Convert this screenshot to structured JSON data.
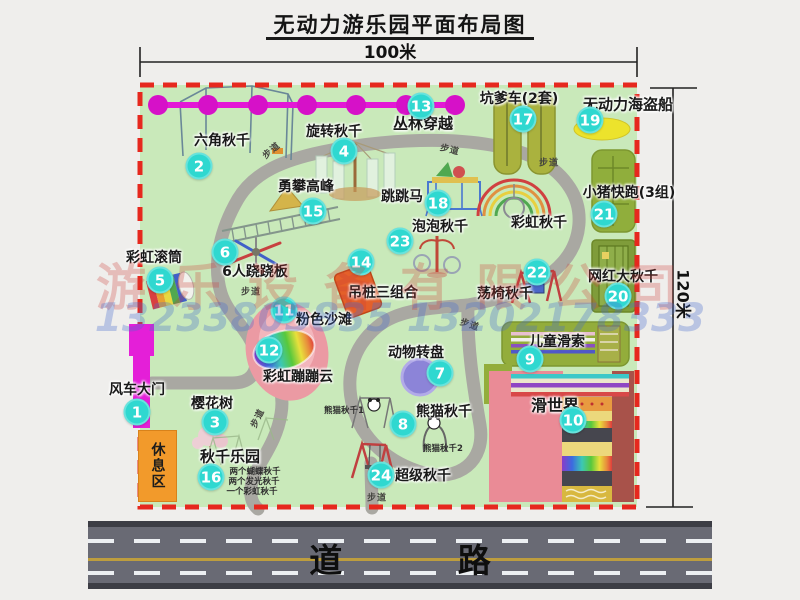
{
  "title": "无动力游乐园平面布局图",
  "dimensions": {
    "width": "100米",
    "height": "120米"
  },
  "road": {
    "label": "道 路"
  },
  "watermark": {
    "company": "游乐设备有限公司",
    "phone": "13233805835 13202178333"
  },
  "rest_area": {
    "label": "休息区"
  },
  "colors": {
    "badge": "#2fd8d0",
    "border": "#e6281e",
    "gate": "#e41fd8",
    "chain": "#e318d6",
    "map_bg": "#c9e9ba"
  },
  "attractions": [
    {
      "num": "1",
      "label": "风车大门",
      "lx": 137,
      "ly": 389,
      "bx": 137,
      "by": 412
    },
    {
      "num": "2",
      "label": "六角秋千",
      "lx": 222,
      "ly": 140,
      "bx": 199,
      "by": 166
    },
    {
      "num": "3",
      "label": "樱花树",
      "lx": 212,
      "ly": 403,
      "bx": 215,
      "by": 422
    },
    {
      "num": "4",
      "label": "旋转秋千",
      "lx": 334,
      "ly": 131,
      "bx": 344,
      "by": 151
    },
    {
      "num": "5",
      "label": "彩虹滚筒",
      "lx": 154,
      "ly": 257,
      "bx": 160,
      "by": 280
    },
    {
      "num": "6",
      "label": "6人跷跷板",
      "lx": 255,
      "ly": 271,
      "bx": 225,
      "by": 252
    },
    {
      "num": "7",
      "label": "动物转盘",
      "lx": 416,
      "ly": 352,
      "bx": 440,
      "by": 373
    },
    {
      "num": "8",
      "label": "熊猫秋千",
      "lx": 444,
      "ly": 411,
      "bx": 403,
      "by": 424,
      "subs": [
        {
          "t": "熊猫秋千1",
          "x": 344,
          "y": 410
        },
        {
          "t": "熊猫秋千2",
          "x": 443,
          "y": 448
        }
      ]
    },
    {
      "num": "9",
      "label": "儿童滑索",
      "lx": 557,
      "ly": 341,
      "bx": 530,
      "by": 359
    },
    {
      "num": "10",
      "label": "滑世界",
      "lx": 555,
      "ly": 404,
      "bx": 573,
      "by": 420,
      "size": 16
    },
    {
      "num": "11",
      "label": "粉色沙滩",
      "lx": 324,
      "ly": 319,
      "bx": 284,
      "by": 310
    },
    {
      "num": "12",
      "label": "彩虹蹦蹦云",
      "lx": 298,
      "ly": 376,
      "bx": 269,
      "by": 350
    },
    {
      "num": "13",
      "label": "丛林穿越",
      "lx": 423,
      "ly": 123,
      "bx": 421,
      "by": 106,
      "size": 15
    },
    {
      "num": "14",
      "label": "吊桩三组合",
      "lx": 383,
      "ly": 292,
      "bx": 361,
      "by": 262
    },
    {
      "num": "15",
      "label": "勇攀高峰",
      "lx": 306,
      "ly": 186,
      "bx": 313,
      "by": 211
    },
    {
      "num": "16",
      "label": "秋千乐园",
      "lx": 230,
      "ly": 456,
      "bx": 211,
      "by": 477,
      "size": 15,
      "subs": [
        {
          "t": "两个蝴蝶秋千",
          "x": 255,
          "y": 471
        },
        {
          "t": "两个发光秋千",
          "x": 254,
          "y": 481
        },
        {
          "t": "一个彩虹秋千",
          "x": 252,
          "y": 491
        }
      ]
    },
    {
      "num": "17",
      "label": "坑爹车(2套)",
      "lx": 519,
      "ly": 98,
      "bx": 523,
      "by": 119
    },
    {
      "num": "18",
      "label": "跳跳马",
      "lx": 402,
      "ly": 196,
      "bx": 438,
      "by": 203
    },
    {
      "num": "19",
      "label": "无动力海盗船",
      "lx": 628,
      "ly": 104,
      "bx": 590,
      "by": 120,
      "size": 15
    },
    {
      "num": "20",
      "label": "网红大秋千",
      "lx": 623,
      "ly": 276,
      "bx": 618,
      "by": 296
    },
    {
      "num": "21",
      "label": "小猪快跑(3组)",
      "lx": 629,
      "ly": 192,
      "bx": 604,
      "by": 214
    },
    {
      "num": "22",
      "label": "荡椅秋千",
      "lx": 505,
      "ly": 293,
      "bx": 537,
      "by": 272
    },
    {
      "num": "23",
      "label": "泡泡秋千",
      "lx": 440,
      "ly": 226,
      "bx": 400,
      "by": 241
    },
    {
      "num": "24",
      "label": "超级秋千",
      "lx": 423,
      "ly": 475,
      "bx": 381,
      "by": 475
    },
    {
      "num": null,
      "label": "彩虹秋千",
      "lx": 539,
      "ly": 222
    }
  ],
  "walkways": [
    {
      "label": "步道",
      "x": 271,
      "y": 150,
      "rot": -40
    },
    {
      "label": "步道",
      "x": 450,
      "y": 149,
      "rot": 14
    },
    {
      "label": "步道",
      "x": 549,
      "y": 162,
      "rot": 0
    },
    {
      "label": "步道",
      "x": 251,
      "y": 291,
      "rot": 0
    },
    {
      "label": "步道",
      "x": 470,
      "y": 324,
      "rot": 18
    },
    {
      "label": "步道",
      "x": 257,
      "y": 418,
      "rot": -64
    },
    {
      "label": "步道",
      "x": 377,
      "y": 497,
      "rot": 0
    }
  ]
}
